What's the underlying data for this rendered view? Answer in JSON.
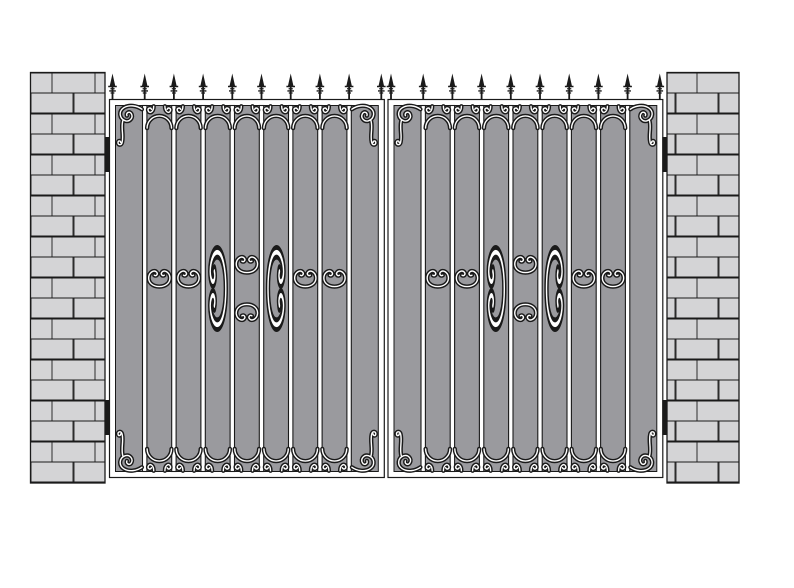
{
  "meta": {
    "description": "Technical line illustration of a double wrought-iron driveway gate hung between two brick pillars"
  },
  "colors": {
    "background": "#ffffff",
    "panel": "#9a9a9e",
    "brick": "#d4d4d6",
    "line": "#1a1a1a",
    "metal": "#ffffff"
  },
  "gate": {
    "leaf_count": 2,
    "bars_per_leaf": 8,
    "panels_per_leaf": 9,
    "finials_per_leaf": 10,
    "finials_total": 20,
    "hinges_per_leaf": 2,
    "finial_style": "spear-point",
    "ornament_top_row": "scroll arches between bars",
    "ornament_bottom_row": "mirrored scroll arches",
    "ornament_mid_sides": "paired C-scrolls",
    "ornament_center": "circular scroll medallion",
    "ornament_corners": "large S-scrolls"
  },
  "pillars": {
    "count": 2,
    "texture": "running-bond brick",
    "brick_rows": 20
  }
}
